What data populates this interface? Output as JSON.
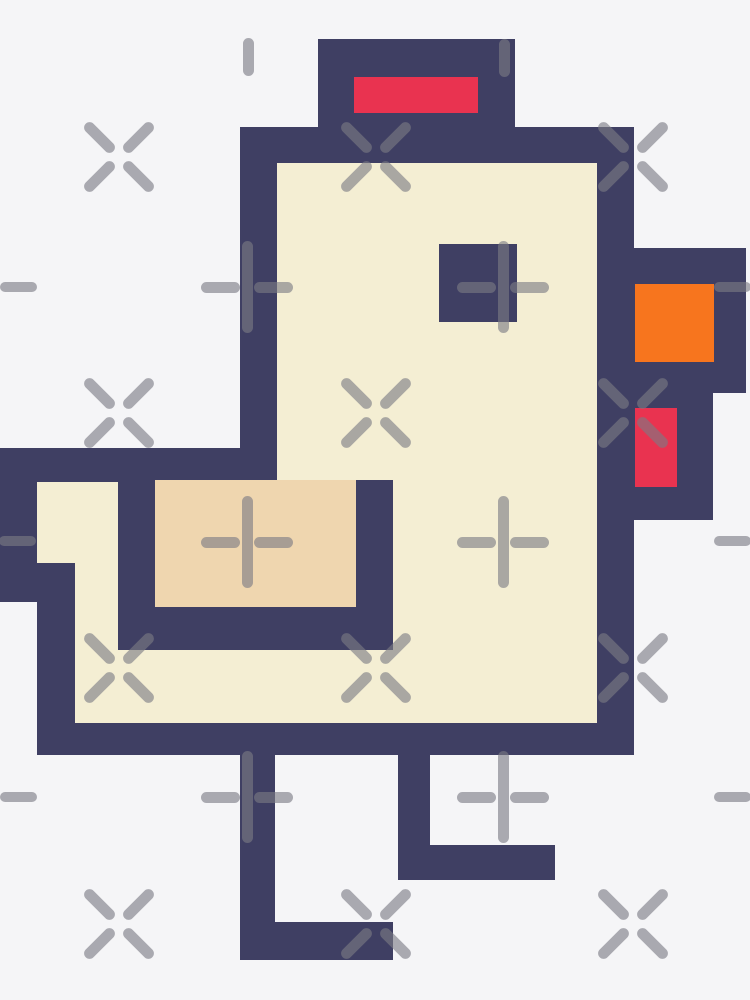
{
  "artwork": {
    "description": "pixel-art chicken sticker on transparency-pattern background",
    "canvas": {
      "width": 750,
      "height": 1000
    },
    "palette": {
      "background": "#f5f5f7",
      "outline": "#3f3f63",
      "body": "#f4eed3",
      "wing": "#efd6af",
      "comb": "#e93350",
      "beak": "#f7751e",
      "pattern": "rgba(122,122,132,0.62)"
    },
    "parts": [
      {
        "name": "head-top-outline",
        "color": "outline",
        "x": 318,
        "y": 39,
        "w": 197,
        "h": 88
      },
      {
        "name": "comb-fill",
        "color": "comb",
        "x": 354,
        "y": 77,
        "w": 124,
        "h": 36
      },
      {
        "name": "head-band-outline",
        "color": "outline",
        "x": 240,
        "y": 127,
        "w": 394,
        "h": 36
      },
      {
        "name": "face-left-outline",
        "color": "outline",
        "x": 240,
        "y": 163,
        "w": 37,
        "h": 317
      },
      {
        "name": "face-right-outline",
        "color": "outline",
        "x": 597,
        "y": 163,
        "w": 37,
        "h": 592
      },
      {
        "name": "beak-outline",
        "color": "outline",
        "x": 596,
        "y": 248,
        "w": 150,
        "h": 145
      },
      {
        "name": "beak-fill",
        "color": "beak",
        "x": 635,
        "y": 284,
        "w": 79,
        "h": 78
      },
      {
        "name": "wattle-outline",
        "color": "outline",
        "x": 596,
        "y": 393,
        "w": 117,
        "h": 127
      },
      {
        "name": "wattle-fill",
        "color": "comb",
        "x": 635,
        "y": 408,
        "w": 42,
        "h": 79
      },
      {
        "name": "tail-top-outline",
        "color": "outline",
        "x": 0,
        "y": 448,
        "w": 277,
        "h": 34
      },
      {
        "name": "tail-left-upper-outline",
        "color": "outline",
        "x": 0,
        "y": 482,
        "w": 37,
        "h": 120
      },
      {
        "name": "tail-left-lower-outline",
        "color": "outline",
        "x": 37,
        "y": 563,
        "w": 38,
        "h": 160
      },
      {
        "name": "bottom-outline",
        "color": "outline",
        "x": 37,
        "y": 723,
        "w": 597,
        "h": 32
      },
      {
        "name": "body-fill",
        "color": "body",
        "x": 277,
        "y": 163,
        "w": 320,
        "h": 560
      },
      {
        "name": "tail-fill-upper",
        "color": "body",
        "x": 37,
        "y": 482,
        "w": 81,
        "h": 81
      },
      {
        "name": "tail-fill-lower",
        "color": "body",
        "x": 75,
        "y": 563,
        "w": 43,
        "h": 87
      },
      {
        "name": "belly-fill",
        "color": "body",
        "x": 75,
        "y": 650,
        "w": 522,
        "h": 73
      },
      {
        "name": "wing-left-outline",
        "color": "outline",
        "x": 118,
        "y": 482,
        "w": 37,
        "h": 168
      },
      {
        "name": "wing-fill",
        "color": "wing",
        "x": 155,
        "y": 480,
        "w": 201,
        "h": 127
      },
      {
        "name": "wing-right-outline",
        "color": "outline",
        "x": 356,
        "y": 480,
        "w": 37,
        "h": 170
      },
      {
        "name": "wing-bottom-outline",
        "color": "outline",
        "x": 118,
        "y": 607,
        "w": 275,
        "h": 43
      },
      {
        "name": "eye",
        "color": "outline",
        "x": 439,
        "y": 244,
        "w": 78,
        "h": 78
      },
      {
        "name": "left-leg",
        "color": "outline",
        "x": 240,
        "y": 755,
        "w": 35,
        "h": 205
      },
      {
        "name": "left-foot",
        "color": "outline",
        "x": 240,
        "y": 922,
        "w": 153,
        "h": 38
      },
      {
        "name": "right-leg",
        "color": "outline",
        "x": 398,
        "y": 755,
        "w": 32,
        "h": 125
      },
      {
        "name": "right-foot",
        "color": "outline",
        "x": 398,
        "y": 845,
        "w": 157,
        "h": 35
      }
    ],
    "pattern_marks": {
      "stroke": 11,
      "cross_arm_length": 39,
      "cross_arm_offset": 19.1,
      "plus_vertical_length": 92,
      "plus_arm_length": 39,
      "plus_arm_offset": 26.5,
      "cross_rows": [
        157,
        413,
        668,
        924
      ],
      "cross_cols": [
        119,
        376,
        633
      ],
      "plus_rows": [
        287,
        542,
        797
      ],
      "plus_cols": [
        247,
        503
      ],
      "vdashes": [
        {
          "x": 248,
          "y": 57
        },
        {
          "x": 504,
          "y": 58
        }
      ],
      "vdash_size": {
        "w": 11,
        "h": 38
      },
      "hdashes": [
        {
          "x": 18,
          "y": 287
        },
        {
          "x": 732,
          "y": 287
        },
        {
          "x": 17,
          "y": 541
        },
        {
          "x": 732,
          "y": 541
        },
        {
          "x": 18,
          "y": 797
        },
        {
          "x": 732,
          "y": 797
        }
      ],
      "hdash_size": {
        "w": 37,
        "h": 10
      }
    }
  }
}
